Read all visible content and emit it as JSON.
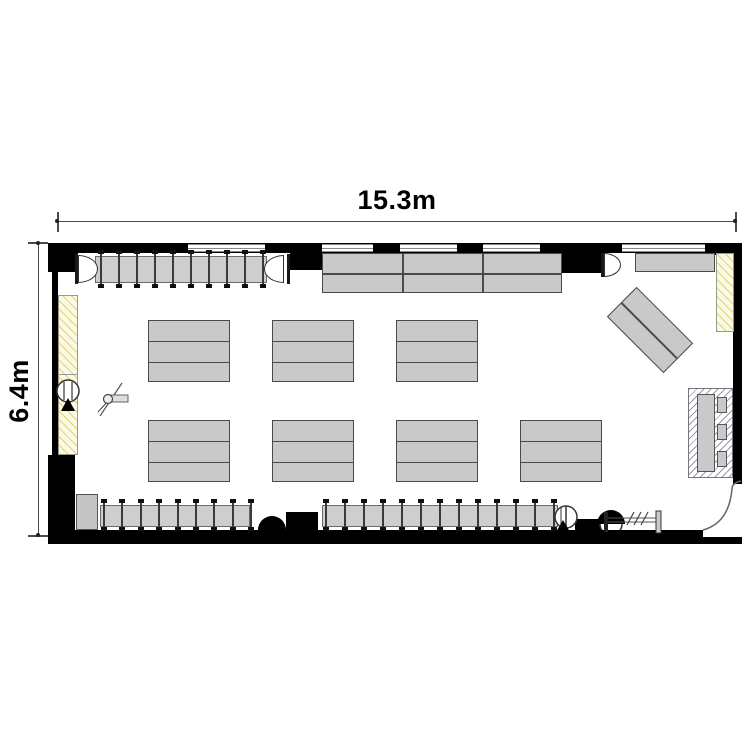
{
  "dimensions": {
    "width_label": "15.3m",
    "height_label": "6.4m"
  },
  "colors": {
    "wall": "#000000",
    "furniture_fill": "#c9c9c9",
    "furniture_border": "#4a4a4a",
    "window_line": "#8a8a8a",
    "yellow_hatch_bg": "#fcf9e2",
    "yellow_hatch_line": "#ddd37f",
    "blue_hatch_line": "#9199b5",
    "dimension_line": "#4a4a4a"
  },
  "geometry": {
    "walls": [
      {
        "n": "top-wall",
        "r": [
          48,
          243,
          694,
          10
        ]
      },
      {
        "n": "left-wall",
        "r": [
          52,
          243,
          6,
          222
        ]
      },
      {
        "n": "right-wall",
        "r": [
          733,
          243,
          9,
          241
        ]
      },
      {
        "n": "bottom-wall",
        "r": [
          48,
          530,
          655,
          14
        ]
      },
      {
        "n": "bottom-wall-right",
        "r": [
          703,
          537,
          39,
          7
        ]
      }
    ],
    "piers": [
      [
        48,
        243,
        30,
        29
      ],
      [
        290,
        243,
        33,
        27
      ],
      [
        560,
        243,
        44,
        30
      ],
      [
        705,
        243,
        37,
        12
      ],
      [
        48,
        455,
        27,
        89
      ],
      [
        286,
        512,
        32,
        18
      ],
      [
        575,
        519,
        30,
        12
      ]
    ],
    "windows": [
      [
        188,
        77
      ],
      [
        322,
        51
      ],
      [
        400,
        57
      ],
      [
        483,
        57
      ],
      [
        622,
        83
      ]
    ],
    "window_band": {
      "y": 244,
      "h": 8
    },
    "tables": [
      {
        "n": "table-block-top",
        "x": 322,
        "y": 253,
        "w": 240,
        "h": 40,
        "rows": 2,
        "cols": 3
      },
      {
        "n": "table-cluster",
        "x": 148,
        "y": 320,
        "w": 82,
        "h": 62,
        "rows": 3,
        "cols": 1
      },
      {
        "n": "table-cluster",
        "x": 272,
        "y": 320,
        "w": 82,
        "h": 62,
        "rows": 3,
        "cols": 1
      },
      {
        "n": "table-cluster",
        "x": 396,
        "y": 320,
        "w": 82,
        "h": 62,
        "rows": 3,
        "cols": 1
      },
      {
        "n": "table-cluster",
        "x": 148,
        "y": 420,
        "w": 82,
        "h": 62,
        "rows": 3,
        "cols": 1
      },
      {
        "n": "table-cluster",
        "x": 272,
        "y": 420,
        "w": 82,
        "h": 62,
        "rows": 3,
        "cols": 1
      },
      {
        "n": "table-cluster",
        "x": 396,
        "y": 420,
        "w": 82,
        "h": 62,
        "rows": 3,
        "cols": 1
      },
      {
        "n": "table-cluster",
        "x": 520,
        "y": 420,
        "w": 82,
        "h": 62,
        "rows": 3,
        "cols": 1
      },
      {
        "n": "angled-table",
        "x": 610,
        "y": 309,
        "w": 80,
        "h": 42,
        "rows": 2,
        "cols": 1,
        "rot": 45
      },
      {
        "n": "work-counter",
        "x": 635,
        "y": 253,
        "w": 80,
        "h": 19,
        "rows": 1,
        "cols": 1
      }
    ],
    "racks": [
      {
        "n": "hanger-rack-top",
        "panel": [
          95,
          256,
          172,
          27
        ],
        "x0": 100,
        "s": 18,
        "np": 10,
        "py": 251,
        "ph": 36
      },
      {
        "n": "hanger-rack-bottom-left",
        "panel": [
          100,
          505,
          150,
          22
        ],
        "x0": 103,
        "s": 18.4,
        "np": 9,
        "py": 500,
        "ph": 30
      },
      {
        "n": "hanger-rack-bottom-right",
        "panel": [
          322,
          505,
          236,
          22
        ],
        "x0": 325,
        "s": 19,
        "np": 13,
        "py": 500,
        "ph": 30
      }
    ],
    "end_caps": [
      {
        "x": 78,
        "y": 255,
        "w": 20,
        "h": 28,
        "side": "right"
      },
      {
        "x": 264,
        "y": 255,
        "w": 20,
        "h": 28,
        "side": "left"
      },
      {
        "x": 604,
        "y": 253,
        "w": 17,
        "h": 24,
        "side": "right"
      }
    ],
    "end_bars": [
      [
        75,
        254,
        3,
        30
      ],
      [
        287,
        254,
        3,
        30
      ],
      [
        601,
        253,
        3,
        24
      ]
    ],
    "domes": [
      [
        258,
        516,
        28,
        14
      ]
    ],
    "yellow_panels": [
      {
        "x": 58,
        "y": 295,
        "w": 20,
        "h": 160,
        "div": 78
      },
      {
        "x": 716,
        "y": 253,
        "w": 18,
        "h": 79
      }
    ],
    "lockers": [
      [
        76,
        494,
        22,
        36
      ]
    ],
    "hatch_box": {
      "box": [
        688,
        388,
        45,
        90
      ],
      "unit": [
        697,
        394,
        18,
        78
      ],
      "cells": [
        [
          717,
          397,
          10,
          16
        ],
        [
          717,
          424,
          10,
          16
        ],
        [
          717,
          451,
          10,
          16
        ]
      ]
    }
  }
}
